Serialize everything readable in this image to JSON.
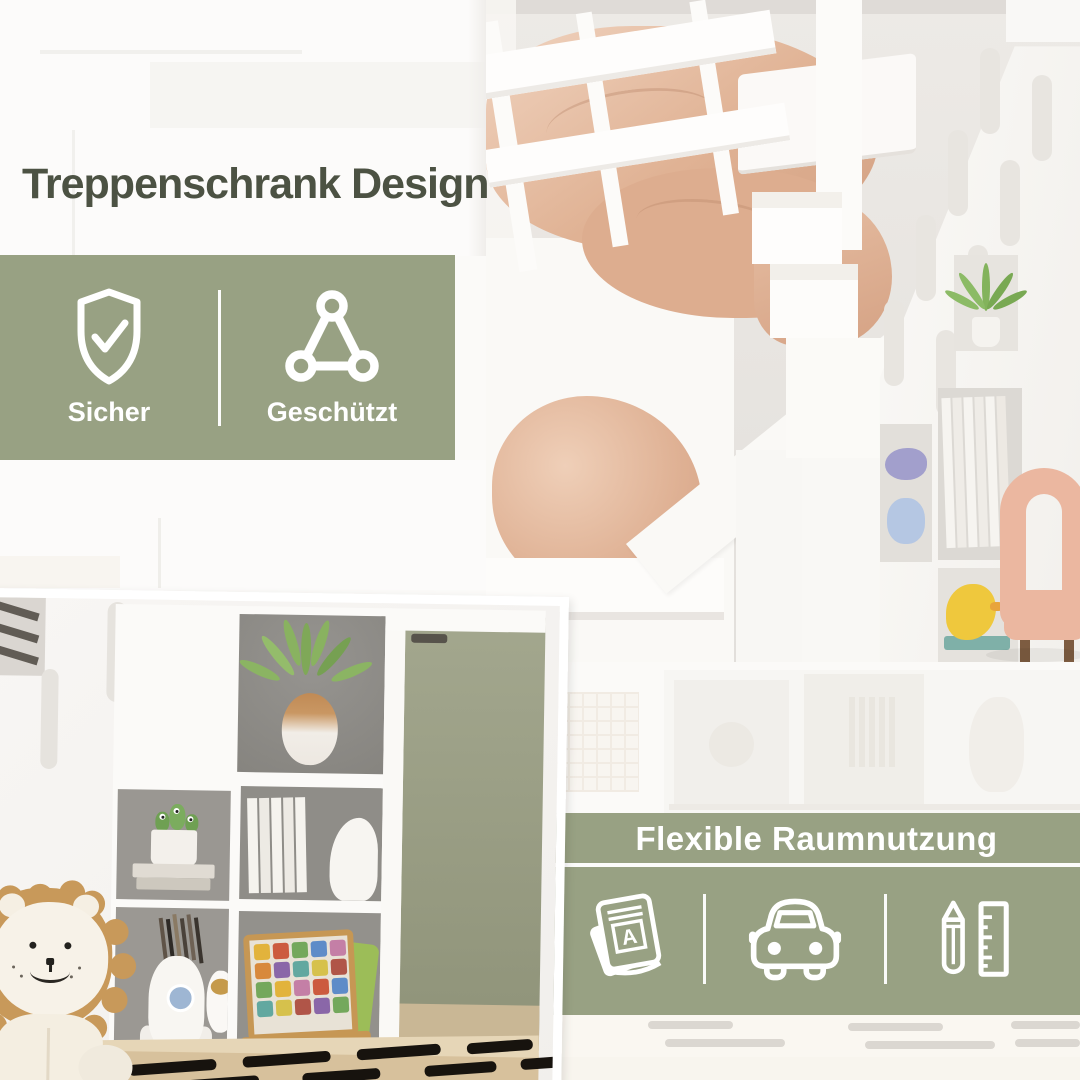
{
  "theme": {
    "banner_green": "#98A183",
    "headline_color": "#4C5243",
    "icon_color": "#FFFFFF",
    "canvas_bg": "#FBFAF8",
    "bedding_peach": "#DFB49A",
    "wardrobe_sage": "#9EA289"
  },
  "headline": {
    "text": "Treppenschrank Design"
  },
  "safety_banner": {
    "items": [
      {
        "icon": "shield-check-icon",
        "label": "Sicher"
      },
      {
        "icon": "triangle-nodes-icon",
        "label": "Geschützt"
      }
    ]
  },
  "flex_banner": {
    "title": "Flexible Raumnutzung",
    "icons": [
      "stacked-books-icon",
      "car-icon",
      "pencil-ruler-icon"
    ]
  },
  "photos": {
    "top_right": {
      "name": "bunk-bed-with-stair-storage-photo"
    },
    "bottom_left": {
      "name": "cube-shelf-with-toys-photo"
    }
  }
}
